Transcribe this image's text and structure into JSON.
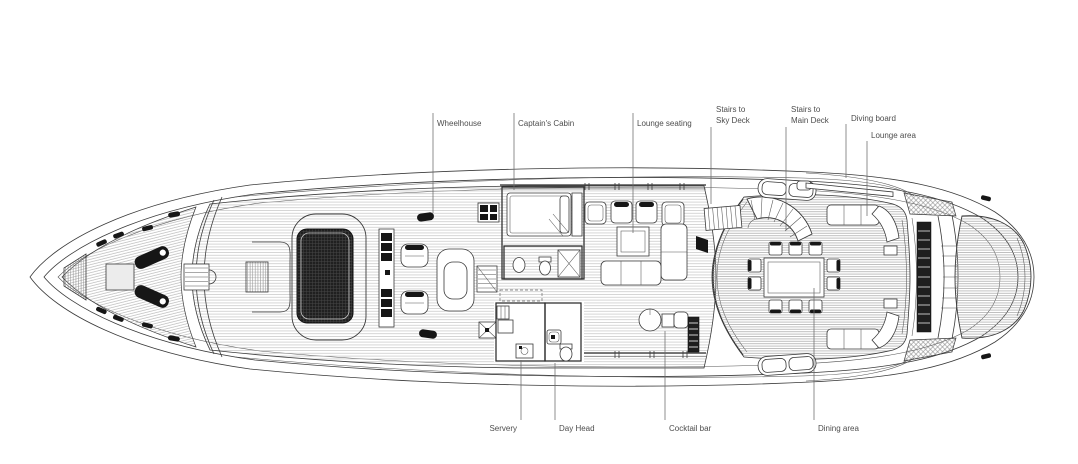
{
  "diagram": {
    "kind": "yacht-deck-plan"
  },
  "labels": {
    "wheelhouse": {
      "text": "Wheelhouse"
    },
    "captains_cabin": {
      "text": "Captain's Cabin"
    },
    "lounge_seating": {
      "text": "Lounge seating"
    },
    "stairs_sky_deck": {
      "line1": "Stairs to",
      "line2": "Sky Deck"
    },
    "stairs_main_deck": {
      "line1": "Stairs to",
      "line2": "Main Deck"
    },
    "diving_board": {
      "text": "Diving board"
    },
    "lounge_area": {
      "text": "Lounge area"
    },
    "servery": {
      "text": "Servery"
    },
    "day_head": {
      "text": "Day Head"
    },
    "cocktail_bar": {
      "text": "Cocktail bar"
    },
    "dining_area": {
      "text": "Dining area"
    }
  },
  "colors": {
    "background": "#ffffff",
    "line": "#3a3a3a",
    "label_text": "#4d4d4d",
    "dark_fill": "#161616",
    "deck_hatch": "#9b9b9b"
  }
}
